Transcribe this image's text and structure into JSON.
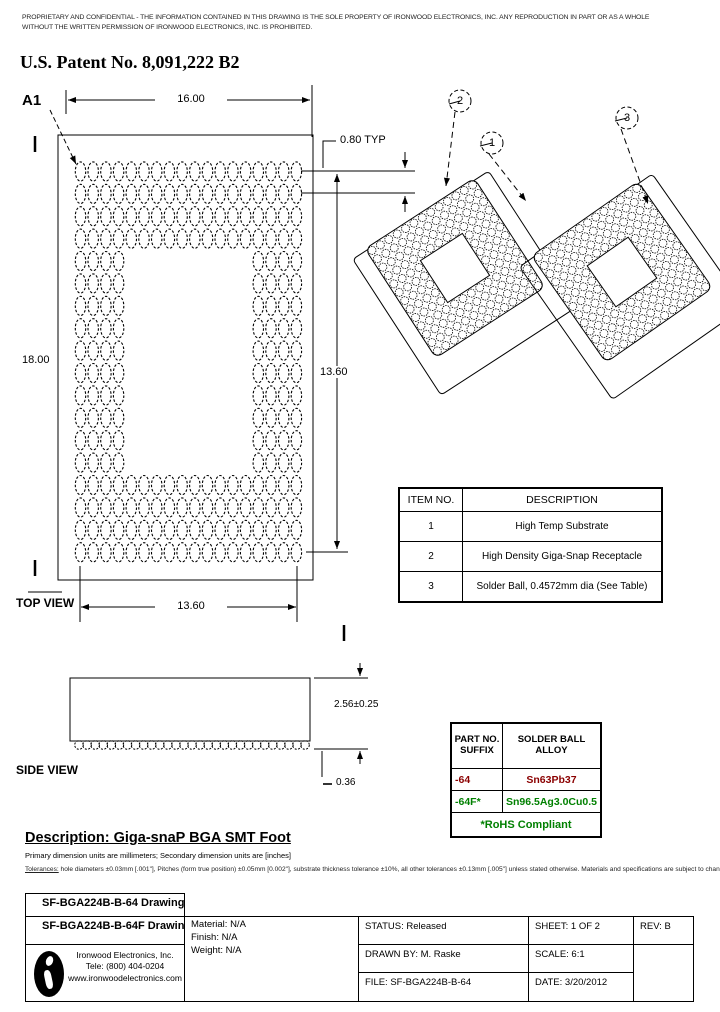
{
  "header": {
    "disclaimer_line1": "PROPRIETARY AND CONFIDENTIAL - THE INFORMATION CONTAINED IN THIS DRAWING IS THE SOLE PROPERTY OF IRONWOOD ELECTRONICS, INC. ANY REPRODUCTION IN PART OR AS A WHOLE",
    "disclaimer_line2": "WITHOUT THE WRITTEN PERMISSION OF IRONWOOD ELECTRONICS, INC. IS PROHIBITED.",
    "patent": "U.S. Patent No. 8,091,222 B2"
  },
  "top_view": {
    "label": "TOP VIEW",
    "pin_a1": "A1",
    "dim_width": "16.00",
    "dim_height": "18.00",
    "dim_array_width": "13.60",
    "dim_array_height": "13.60",
    "dim_pitch": "0.80 TYP",
    "grid": {
      "cols": 18,
      "rows": 18,
      "hole_start": 4,
      "hole_end": 13
    }
  },
  "side_view": {
    "label": "SIDE VIEW",
    "dim_height": "2.56±0.25",
    "dim_ball": "0.36",
    "bump_count": 29
  },
  "iso": {
    "callouts": [
      "1",
      "2",
      "3"
    ],
    "dots": {
      "n": 13,
      "hole_start": 4,
      "hole_end": 8
    }
  },
  "item_table": {
    "headers": [
      "ITEM NO.",
      "DESCRIPTION"
    ],
    "rows": [
      [
        "1",
        "High Temp Substrate"
      ],
      [
        "2",
        "High Density Giga-Snap Receptacle"
      ],
      [
        "3",
        "Solder Ball, 0.4572mm dia (See Table)"
      ]
    ]
  },
  "alloy_table": {
    "col1_header_line1": "PART NO.",
    "col1_header_line2": "SUFFIX",
    "col2_header": "SOLDER BALL ALLOY",
    "rows": [
      {
        "suffix": "-64",
        "alloy": "Sn63Pb37",
        "color": "#8b0000"
      },
      {
        "suffix": "-64F*",
        "alloy": "Sn96.5Ag3.0Cu0.5",
        "color": "#008000"
      }
    ],
    "footer": "*RoHS Compliant",
    "footer_color": "#008000"
  },
  "description": {
    "heading": "Description: Giga-snaP BGA SMT Foot",
    "units_note": "Primary dimension units are millimeters; Secondary dimension units are [inches]",
    "tolerances_label": "Tolerances:",
    "tolerances_text": " hole diameters ±0.03mm [.001\"], Pitches (form true position) ±0.05mm [0.002\"], substrate thickness tolerance ±10%, all other tolerances ±0.13mm [.005\"] unless stated otherwise. Materials and specifications are subject to change without notice."
  },
  "title_block": {
    "part1": "SF-BGA224B-B-64 Drawing",
    "part2": "SF-BGA224B-B-64F Drawing",
    "company_line1": "Ironwood Electronics, Inc.",
    "company_line2": "Tele: (800) 404-0204",
    "company_line3": "www.ironwoodelectronics.com",
    "material": "Material: N/A",
    "finish": "Finish: N/A",
    "weight": "Weight: N/A",
    "status": "STATUS: Released",
    "drawn_by": "DRAWN BY: M. Raske",
    "file": "FILE: SF-BGA224B-B-64",
    "sheet": "SHEET: 1 OF 2",
    "scale": "SCALE: 6:1",
    "date": "DATE: 3/20/2012",
    "rev": "REV: B"
  }
}
